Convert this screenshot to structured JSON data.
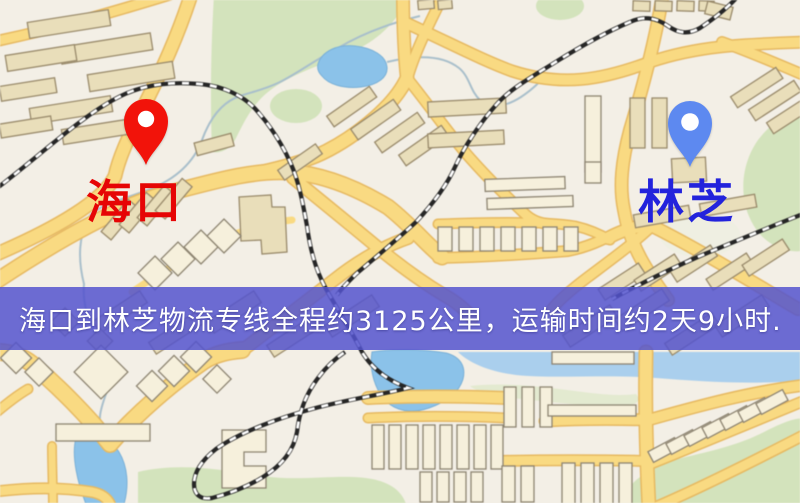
{
  "origin": {
    "name": "海口",
    "label_color": "#e60505",
    "pin_color": "#f2130a"
  },
  "destination": {
    "name": "林芝",
    "label_color": "#2323dc",
    "pin_color": "#5d89f0"
  },
  "banner": {
    "text": "海口到林芝物流专线全程约3125公里，运输时间约2天9小时.",
    "background_color": "rgba(83,83,206,0.85)",
    "text_color": "#ffffff"
  },
  "map_palette": {
    "background": "#f3efe6",
    "road_fill": "#f8da85",
    "road_casing": "#e5b964",
    "water": "#8cc2e8",
    "park": "#d3e3bd",
    "building": "#e9debb",
    "railway": "#262626"
  }
}
